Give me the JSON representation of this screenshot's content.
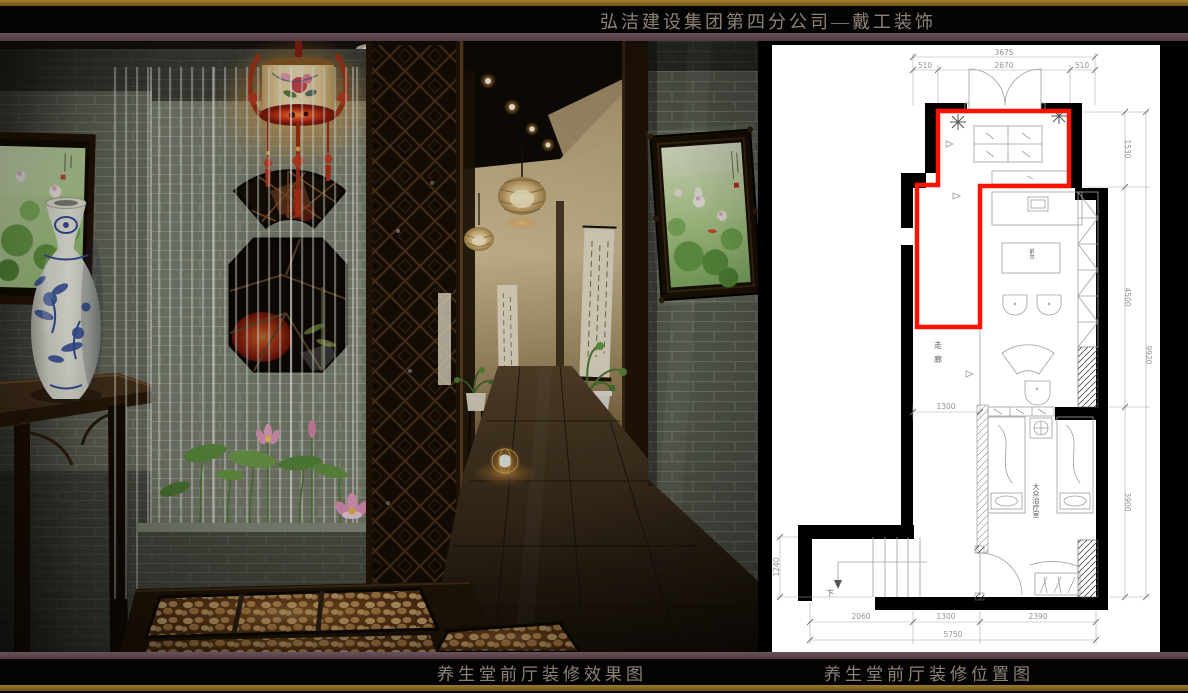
{
  "header": {
    "title": "弘洁建设集团第四分公司—戴工装饰"
  },
  "captions": {
    "left": "养生堂前厅装修效果图",
    "right": "养生堂前厅装修位置图"
  },
  "colors": {
    "gold_rule": "#8a6a28",
    "divider_rule": "#5d4a4e",
    "caption_text": "#8e8276",
    "plan_highlight_red": "#ff1200",
    "plan_wall": "#000000"
  },
  "floor_plan": {
    "dims": {
      "top_total": "3675",
      "top_left": "510",
      "top_mid": "2670",
      "top_right": "510",
      "right_1": "1530",
      "right_2": "4500",
      "right_3": "3900",
      "right_total": "9920",
      "left_stair": "1240",
      "mid_corridor": "1300",
      "bottom_1": "2060",
      "bottom_2": "1300",
      "bottom_3": "2390",
      "bottom_total": "5750"
    },
    "labels": {
      "corridor": "走廊",
      "treatment_room": "大众治疗室",
      "reception": "前台",
      "stairs_down": "下"
    }
  },
  "scene_elements": [
    "palace-lantern",
    "porcelain-vase",
    "lotus-painting-left",
    "lotus-painting-right",
    "water-curtain",
    "lotus-planter",
    "lattice-screen",
    "hallway",
    "pebble-floor",
    "fan-window",
    "octagon-window",
    "console-table"
  ]
}
